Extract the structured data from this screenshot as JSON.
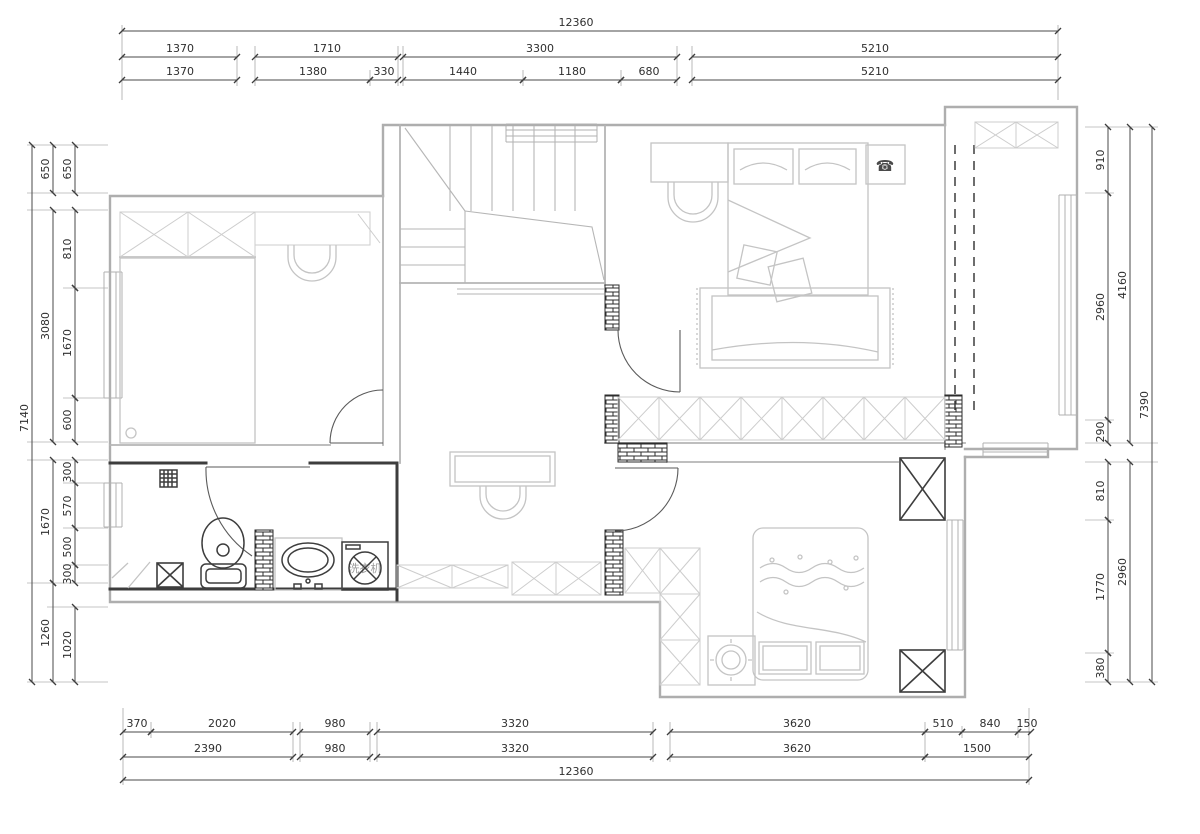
{
  "drawing": {
    "type": "residential floor plan",
    "units": "mm"
  },
  "labels": {
    "washing_machine": "洗衣机"
  },
  "icons": {
    "phone": "☎"
  },
  "colors": {
    "wall_light": "#aeaeae",
    "wall_dark": "#3d3d3d",
    "dim_line": "#4a4a4a",
    "furniture": "#c4c4c4",
    "background": "#ffffff"
  },
  "dims": {
    "top": {
      "overall": "12360",
      "row2": [
        "1370",
        "1710",
        "3300",
        "5210"
      ],
      "row3": [
        "1370",
        "1380",
        "330",
        "1440",
        "1180",
        "680",
        "5210"
      ]
    },
    "bottom": {
      "row1": [
        "370",
        "2020",
        "980",
        "3320",
        "3620",
        "510",
        "840",
        "150"
      ],
      "row2": [
        "2390",
        "980",
        "3320",
        "3620",
        "1500"
      ],
      "overall": "12360"
    },
    "left": {
      "outer": "7140",
      "mid": [
        "650",
        "3080",
        "1670",
        "1260"
      ],
      "inner": [
        "650",
        "810",
        "1670",
        "600",
        "300",
        "570",
        "500",
        "300",
        "1020"
      ]
    },
    "right": {
      "outer": "7390",
      "mid": [
        "4160",
        "2960"
      ],
      "inner": [
        "910",
        "2960",
        "290",
        "810",
        "1770",
        "380"
      ]
    }
  }
}
